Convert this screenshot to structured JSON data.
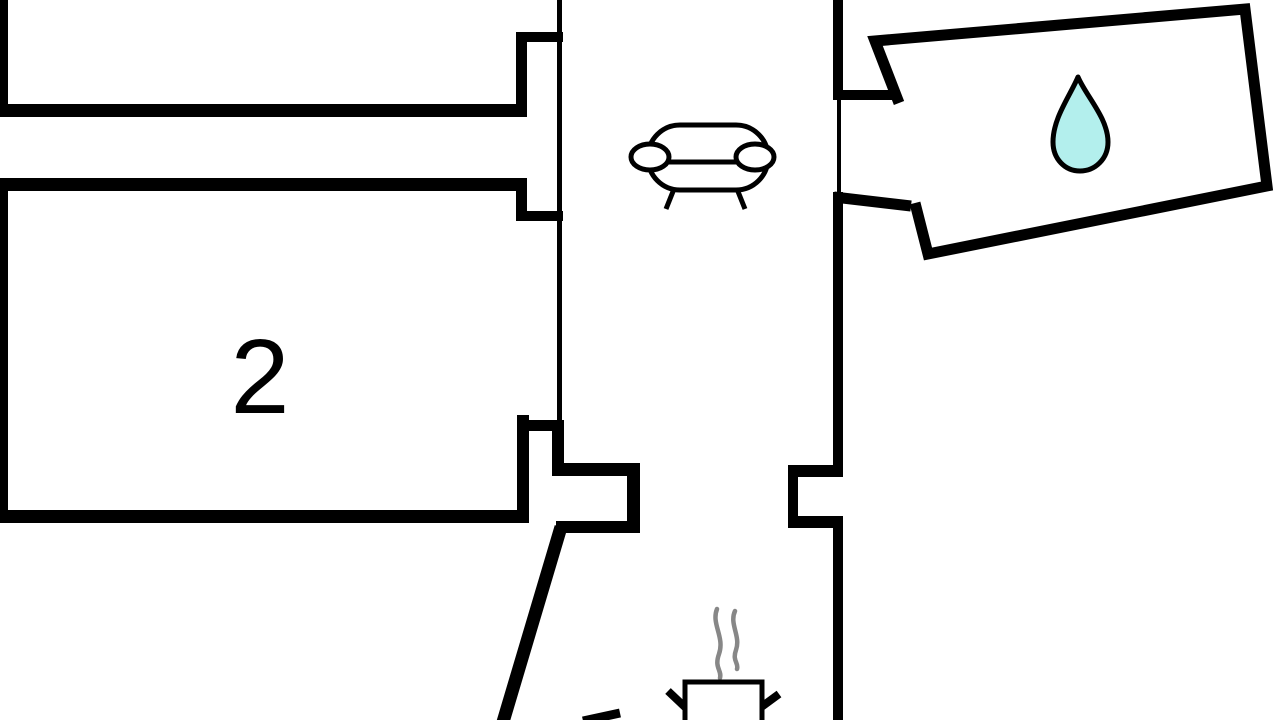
{
  "rooms": {
    "room2": {
      "label": "2"
    }
  },
  "icons": {
    "living_area": "sofa-icon",
    "bathroom": "water-drop-icon",
    "kitchen": "cooking-pot-icon",
    "kitchen_steam": "steam-icon"
  },
  "colors": {
    "background": "#ffffff",
    "wall": "#000000",
    "droplet_fill": "#b3efed",
    "droplet_outline": "#000000",
    "steam": "#878787"
  }
}
